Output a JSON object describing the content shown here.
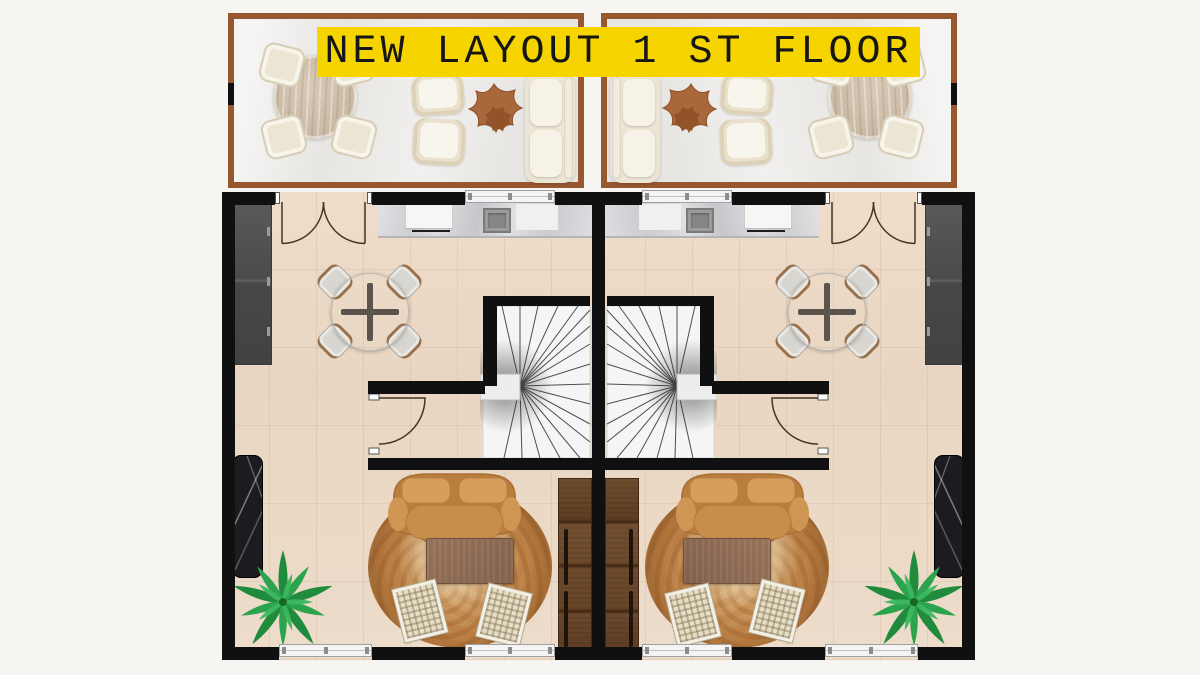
{
  "banner": {
    "label": "NEW LAYOUT 1 ST FLOOR",
    "background_color": "#F6D400",
    "text_color": "#161616"
  },
  "plan": {
    "description": "first-floor plan of two mirrored duplex units with front terraces",
    "units": [
      {
        "name": "left-unit",
        "mirrored": false
      },
      {
        "name": "right-unit",
        "mirrored": true
      }
    ],
    "rooms_per_unit": [
      "terrace",
      "open-kitchen-dining",
      "stair-hall",
      "living-room"
    ],
    "terrace_furniture": [
      "round-wood-dining-table",
      "dining-chair",
      "dining-chair",
      "dining-chair",
      "dining-chair",
      "armchair",
      "armchair",
      "organic-star-coffee-table",
      "outdoor-sofa"
    ],
    "unit_furniture": [
      "wardrobe",
      "kitchen-counter-with-sink-and-cutting-board",
      "round-dining-table-cross-base",
      "dining-chair",
      "dining-chair",
      "dining-chair",
      "dining-chair",
      "winder-staircase",
      "curved-tan-sofa",
      "round-mottled-rug",
      "wood-coffee-table",
      "rattan-chair",
      "rattan-chair",
      "walnut-media-cabinet",
      "black-marble-panel",
      "palm-plant"
    ],
    "openings_per_unit": [
      "french-double-door-top",
      "window-top",
      "interior-swing-door",
      "window-bottom",
      "window-bottom"
    ],
    "colors": {
      "wall": "#101010",
      "floor_tile": "#ecdac6",
      "terrace_floor": "#e8e6e3",
      "terrace_border": "#97572f",
      "stair": "#f5f5f5",
      "sofa_tan": "#c78e4b",
      "rug_brown": "#b97f44",
      "cabinet_walnut": "#6b4830",
      "marble_black": "#1c1c20",
      "plant_green": "#2aa14a",
      "background": "#f6f5f2"
    }
  }
}
